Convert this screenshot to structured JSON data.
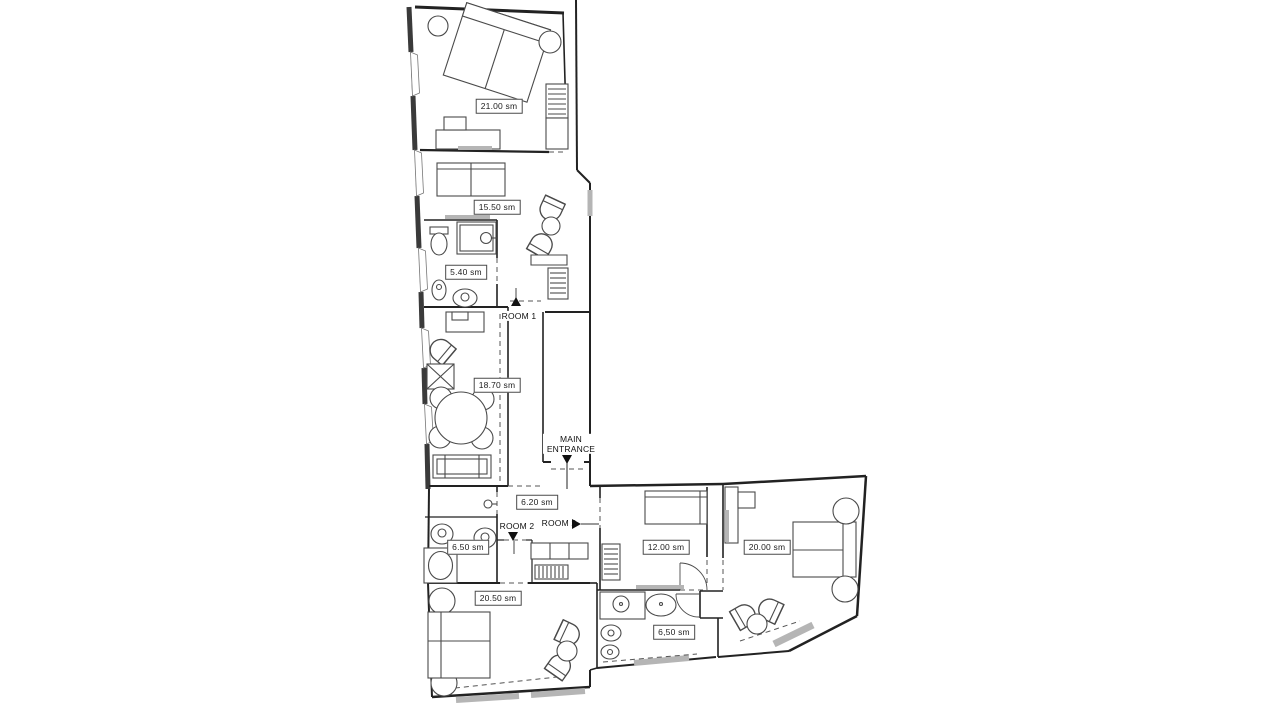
{
  "document": {
    "type": "apartment-floor-plan",
    "units": "sm"
  },
  "colors": {
    "background": "#ffffff",
    "wall": "#222222",
    "furniture": "#4a4a4a",
    "window_sill": "#b5b5b5",
    "label_border": "#4a4a4a"
  },
  "area_labels": [
    {
      "name": "bedroom-21",
      "text": "21.00 sm"
    },
    {
      "name": "bedroom-15-5",
      "text": "15.50 sm"
    },
    {
      "name": "bathroom-5-4",
      "text": "5.40 sm"
    },
    {
      "name": "living-18-7",
      "text": "18.70 sm"
    },
    {
      "name": "hall-6-2",
      "text": "6.20 sm"
    },
    {
      "name": "bathroom-6-5",
      "text": "6.50 sm"
    },
    {
      "name": "bedroom-12",
      "text": "12.00 sm"
    },
    {
      "name": "bedroom-20",
      "text": "20.00 sm"
    },
    {
      "name": "bedroom-20-5",
      "text": "20.50 sm"
    },
    {
      "name": "bathroom-6-5-low",
      "text": "6,50 sm"
    }
  ],
  "markers": [
    {
      "name": "room-1-entrance",
      "text": "ROOM 1",
      "arrow": "up"
    },
    {
      "name": "main-entrance",
      "text": "MAIN ENTRANCE",
      "arrow": "down"
    },
    {
      "name": "room-2-entrance-a",
      "text": "ROOM 2",
      "arrow": "down"
    },
    {
      "name": "room-2-entrance-b",
      "text": "ROOM 2",
      "arrow": "right"
    }
  ]
}
